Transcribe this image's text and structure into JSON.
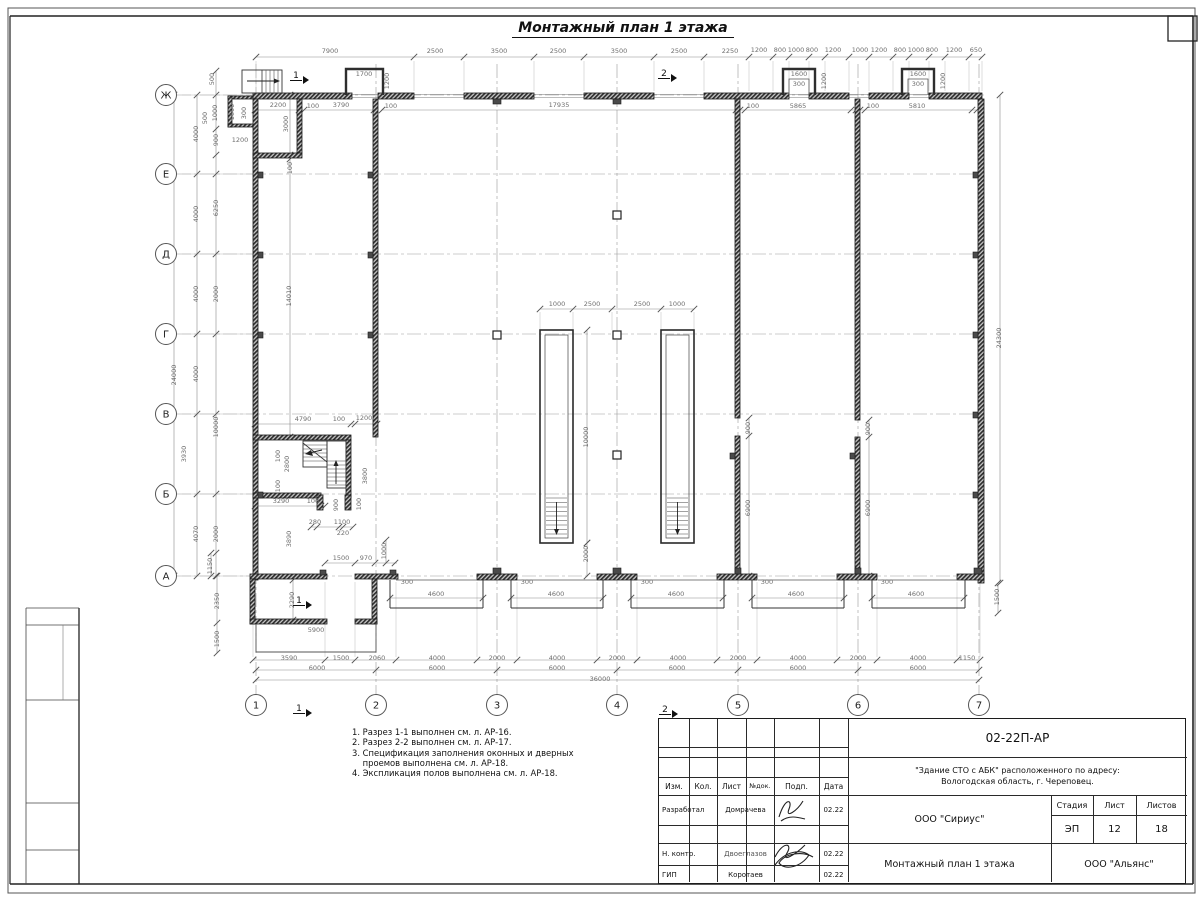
{
  "sheet": {
    "drawing_title": "Монтажный план 1 этажа",
    "notes": [
      "1. Разрез 1-1 выполнен см. л. АР-16.",
      "2. Разрез 2-2 выполнен см. л. АР-17.",
      "3. Спецификация заполнения оконных и дверных",
      "    проемов выполнена см. л. АР-18.",
      "4. Экспликация полов выполнена см. л. АР-18."
    ]
  },
  "axes": {
    "rows": [
      {
        "label": "Ж",
        "y": 95
      },
      {
        "label": "Е",
        "y": 174
      },
      {
        "label": "Д",
        "y": 254
      },
      {
        "label": "Г",
        "y": 334
      },
      {
        "label": "В",
        "y": 414
      },
      {
        "label": "Б",
        "y": 494
      },
      {
        "label": "А",
        "y": 576
      }
    ],
    "cols": [
      {
        "label": "1",
        "x": 256
      },
      {
        "label": "2",
        "x": 376
      },
      {
        "label": "3",
        "x": 497
      },
      {
        "label": "4",
        "x": 617
      },
      {
        "label": "5",
        "x": 738
      },
      {
        "label": "6",
        "x": 858
      },
      {
        "label": "7",
        "x": 979
      }
    ]
  },
  "section_markers": [
    {
      "label": "1",
      "x": 296,
      "y": 78
    },
    {
      "label": "2",
      "x": 664,
      "y": 76
    },
    {
      "label": "1",
      "x": 299,
      "y": 603
    },
    {
      "label": "1",
      "x": 299,
      "y": 711
    },
    {
      "label": "2",
      "x": 665,
      "y": 712
    }
  ],
  "dim_labels": [
    [
      "7900",
      330,
      53,
      0
    ],
    [
      "2500",
      435,
      53,
      0
    ],
    [
      "3500",
      499,
      53,
      0
    ],
    [
      "2500",
      558,
      53,
      0
    ],
    [
      "3500",
      619,
      53,
      0
    ],
    [
      "2500",
      679,
      53,
      0
    ],
    [
      "2250",
      730,
      53,
      0
    ],
    [
      "1200",
      759,
      52,
      0
    ],
    [
      "800",
      780,
      52,
      0
    ],
    [
      "1000",
      796,
      52,
      0
    ],
    [
      "800",
      812,
      52,
      0
    ],
    [
      "1200",
      833,
      52,
      0
    ],
    [
      "1000",
      860,
      52,
      0
    ],
    [
      "1200",
      879,
      52,
      0
    ],
    [
      "800",
      900,
      52,
      0
    ],
    [
      "1000",
      916,
      52,
      0
    ],
    [
      "800",
      932,
      52,
      0
    ],
    [
      "1200",
      954,
      52,
      0
    ],
    [
      "650",
      976,
      52,
      0
    ],
    [
      "1700",
      364,
      76,
      0
    ],
    [
      "1200",
      389,
      81,
      1
    ],
    [
      "1600",
      799,
      76,
      0
    ],
    [
      "300",
      799,
      86,
      0
    ],
    [
      "1200",
      826,
      81,
      1
    ],
    [
      "1600",
      918,
      76,
      0
    ],
    [
      "300",
      918,
      86,
      0
    ],
    [
      "1200",
      945,
      81,
      1
    ],
    [
      "2200",
      278,
      107,
      0
    ],
    [
      "100",
      313,
      108,
      0
    ],
    [
      "3790",
      341,
      107,
      0
    ],
    [
      "100",
      391,
      108,
      0
    ],
    [
      "17935",
      559,
      107,
      0
    ],
    [
      "100",
      753,
      108,
      0
    ],
    [
      "5865",
      798,
      108,
      0
    ],
    [
      "100",
      873,
      108,
      0
    ],
    [
      "5810",
      917,
      108,
      0
    ],
    [
      "3000",
      288,
      124,
      1
    ],
    [
      "100",
      292,
      168,
      1
    ],
    [
      "1600",
      234,
      112,
      1
    ],
    [
      "300",
      246,
      113,
      1
    ],
    [
      "1200",
      240,
      142,
      0
    ],
    [
      "500",
      214,
      79,
      1
    ],
    [
      "500",
      207,
      118,
      1
    ],
    [
      "1000",
      217,
      113,
      1
    ],
    [
      "900",
      218,
      140,
      1
    ],
    [
      "4000",
      198,
      134,
      1
    ],
    [
      "4000",
      198,
      214,
      1
    ],
    [
      "6250",
      218,
      208,
      1
    ],
    [
      "4000",
      198,
      294,
      1
    ],
    [
      "2000",
      218,
      294,
      1
    ],
    [
      "14010",
      291,
      296,
      1
    ],
    [
      "24000",
      176,
      375,
      1
    ],
    [
      "4000",
      198,
      374,
      1
    ],
    [
      "10000",
      218,
      427,
      1
    ],
    [
      "3930",
      186,
      454,
      1
    ],
    [
      "4070",
      198,
      534,
      1
    ],
    [
      "2000",
      218,
      534,
      1
    ],
    [
      "1150",
      212,
      566,
      1
    ],
    [
      "2350",
      219,
      601,
      1
    ],
    [
      "1500",
      219,
      639,
      1
    ],
    [
      "3890",
      291,
      539,
      1
    ],
    [
      "4790",
      303,
      421,
      0
    ],
    [
      "100",
      339,
      421,
      0
    ],
    [
      "1200",
      364,
      420,
      0
    ],
    [
      "100",
      280,
      456,
      1
    ],
    [
      "2800",
      289,
      464,
      1
    ],
    [
      "100",
      280,
      486,
      1
    ],
    [
      "3290",
      281,
      503,
      0
    ],
    [
      "100",
      313,
      503,
      0
    ],
    [
      "900",
      338,
      505,
      1
    ],
    [
      "3800",
      367,
      476,
      1
    ],
    [
      "100",
      361,
      504,
      1
    ],
    [
      "280",
      315,
      524,
      0
    ],
    [
      "1100",
      342,
      524,
      0
    ],
    [
      "220",
      343,
      535,
      0
    ],
    [
      "1000",
      386,
      551,
      1
    ],
    [
      "1500",
      341,
      560,
      0
    ],
    [
      "970",
      366,
      560,
      0
    ],
    [
      "2290",
      294,
      600,
      1
    ],
    [
      "5900",
      316,
      632,
      0
    ],
    [
      "3590",
      289,
      660,
      0
    ],
    [
      "1500",
      341,
      660,
      0
    ],
    [
      "2060",
      377,
      660,
      0
    ],
    [
      "4000",
      437,
      660,
      0
    ],
    [
      "2000",
      497,
      660,
      0
    ],
    [
      "4000",
      557,
      660,
      0
    ],
    [
      "2000",
      617,
      660,
      0
    ],
    [
      "4000",
      678,
      660,
      0
    ],
    [
      "2000",
      738,
      660,
      0
    ],
    [
      "4000",
      798,
      660,
      0
    ],
    [
      "2000",
      858,
      660,
      0
    ],
    [
      "4000",
      918,
      660,
      0
    ],
    [
      "1150",
      967,
      660,
      0
    ],
    [
      "6000",
      317,
      670,
      0
    ],
    [
      "6000",
      437,
      670,
      0
    ],
    [
      "6000",
      557,
      670,
      0
    ],
    [
      "6000",
      677,
      670,
      0
    ],
    [
      "6000",
      798,
      670,
      0
    ],
    [
      "6000",
      918,
      670,
      0
    ],
    [
      "36000",
      600,
      681,
      0
    ],
    [
      "300",
      407,
      584,
      0
    ],
    [
      "300",
      527,
      584,
      0
    ],
    [
      "300",
      647,
      584,
      0
    ],
    [
      "300",
      767,
      584,
      0
    ],
    [
      "300",
      887,
      584,
      0
    ],
    [
      "4600",
      436,
      596,
      0
    ],
    [
      "4600",
      556,
      596,
      0
    ],
    [
      "4600",
      676,
      596,
      0
    ],
    [
      "4600",
      796,
      596,
      0
    ],
    [
      "4600",
      916,
      596,
      0
    ],
    [
      "1000",
      557,
      306,
      0
    ],
    [
      "2500",
      592,
      306,
      0
    ],
    [
      "2500",
      642,
      306,
      0
    ],
    [
      "1000",
      677,
      306,
      0
    ],
    [
      "10000",
      588,
      437,
      1
    ],
    [
      "2000",
      588,
      554,
      1
    ],
    [
      "900",
      750,
      428,
      1
    ],
    [
      "6900",
      750,
      508,
      1
    ],
    [
      "900",
      870,
      429,
      1
    ],
    [
      "6900",
      870,
      508,
      1
    ],
    [
      "24300",
      1001,
      338,
      1
    ],
    [
      "1500",
      999,
      597,
      1
    ]
  ],
  "titleblock": {
    "doc_number": "02-22П-АР",
    "object_line1": "\"Здание СТО с АБК\" расположенного по адресу:",
    "object_line2": "Вологодская область, г. Череповец.",
    "col_headers": {
      "izm": "Изм.",
      "kol": "Кол.",
      "list": "Лист",
      "ndoc": "№док.",
      "podp": "Подп.",
      "data": "Дата"
    },
    "rows": [
      {
        "role": "Разработал",
        "name": "Домрачева",
        "date": "02.22"
      },
      {
        "role": "Н. контр.",
        "name": "Двоеглазов",
        "date": "02.22"
      },
      {
        "role": "ГИП",
        "name": "Коротаев",
        "date": "02.22"
      }
    ],
    "org": "ООО \"Сириус\"",
    "stage_label": "Стадия",
    "sheet_label": "Лист",
    "sheets_label": "Листов",
    "stage": "ЭП",
    "sheet_no": "12",
    "sheets_total": "18",
    "sheet_title": "Монтажный план 1 этажа",
    "company": "ООО \"Альянс\""
  }
}
